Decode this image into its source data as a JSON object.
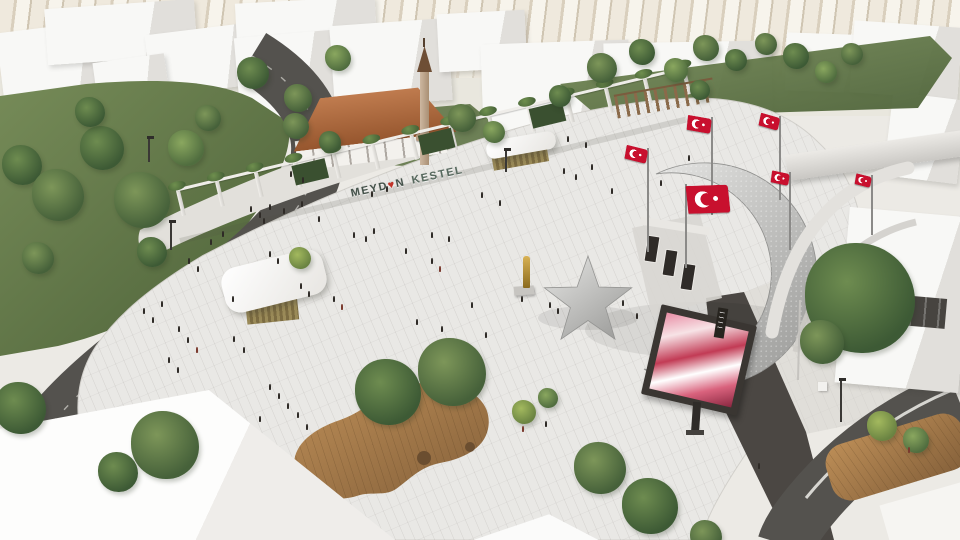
{
  "sign": {
    "word1": "MEYD",
    "heart": "♥",
    "word2": "N",
    "word3": "KESTEL"
  },
  "colors": {
    "flag_red": "#c8102e",
    "flag_red_dark": "#a50f26",
    "asphalt": "#54524e",
    "paving": "#e9e8e5",
    "roof_terracotta": "#b06a3e",
    "gold": "#c9a13b",
    "metal_light": "#e6e6e4",
    "metal_dark": "#9e9e9c",
    "wood_light": "#bd8e57",
    "wood_dark": "#84603a",
    "tree_tones": [
      [
        "#7d9659",
        "#46613a"
      ],
      [
        "#6e8c50",
        "#3d5a35"
      ],
      [
        "#8aa75f",
        "#506d3f"
      ],
      [
        "#a3b95e",
        "#6a8342"
      ]
    ],
    "people": [
      "#2e2a26",
      "#3b342d",
      "#4a3a31",
      "#574a40",
      "#7a3a2e"
    ]
  },
  "scene": {
    "pergola": {
      "x": 182,
      "y": 216,
      "len": 520,
      "angle": -13.5,
      "posts": 14,
      "panels": [
        118,
        248,
        362
      ]
    },
    "trees": [
      [
        22,
        165,
        20,
        1
      ],
      [
        58,
        195,
        26,
        0
      ],
      [
        102,
        148,
        22,
        1
      ],
      [
        142,
        200,
        28,
        0
      ],
      [
        186,
        148,
        18,
        2
      ],
      [
        90,
        112,
        15,
        1
      ],
      [
        208,
        118,
        13,
        0
      ],
      [
        152,
        252,
        15,
        1
      ],
      [
        38,
        258,
        16,
        0
      ],
      [
        20,
        408,
        26,
        1
      ],
      [
        165,
        445,
        34,
        0
      ],
      [
        118,
        472,
        20,
        1
      ],
      [
        253,
        73,
        16,
        1
      ],
      [
        298,
        98,
        14,
        0
      ],
      [
        338,
        58,
        13,
        2
      ],
      [
        296,
        126,
        13,
        0
      ],
      [
        330,
        142,
        11,
        1
      ],
      [
        462,
        118,
        14,
        0
      ],
      [
        494,
        132,
        11,
        2
      ],
      [
        560,
        96,
        11,
        1
      ],
      [
        602,
        68,
        15,
        0
      ],
      [
        642,
        52,
        13,
        1
      ],
      [
        676,
        70,
        12,
        2
      ],
      [
        706,
        48,
        13,
        0
      ],
      [
        736,
        60,
        11,
        1
      ],
      [
        766,
        44,
        11,
        0
      ],
      [
        796,
        56,
        13,
        1
      ],
      [
        826,
        72,
        11,
        2
      ],
      [
        852,
        54,
        11,
        0
      ],
      [
        700,
        90,
        10,
        1
      ],
      [
        388,
        392,
        33,
        1,
        14
      ],
      [
        452,
        372,
        34,
        0,
        16
      ],
      [
        524,
        412,
        12,
        3
      ],
      [
        548,
        398,
        10,
        2
      ],
      [
        600,
        468,
        26,
        0
      ],
      [
        650,
        506,
        28,
        1
      ],
      [
        706,
        536,
        16,
        0
      ],
      [
        860,
        298,
        55,
        1
      ],
      [
        822,
        342,
        22,
        0
      ],
      [
        882,
        426,
        15,
        3
      ],
      [
        916,
        440,
        13,
        2
      ],
      [
        300,
        258,
        11,
        3
      ]
    ],
    "people": [
      [
        143,
        313
      ],
      [
        152,
        322
      ],
      [
        161,
        306
      ],
      [
        178,
        331
      ],
      [
        187,
        342
      ],
      [
        196,
        352,
        4
      ],
      [
        168,
        362
      ],
      [
        177,
        372
      ],
      [
        233,
        341
      ],
      [
        243,
        352
      ],
      [
        188,
        263
      ],
      [
        197,
        271
      ],
      [
        250,
        211
      ],
      [
        259,
        217
      ],
      [
        269,
        209
      ],
      [
        300,
        288
      ],
      [
        308,
        296
      ],
      [
        269,
        256
      ],
      [
        277,
        263
      ],
      [
        318,
        221
      ],
      [
        333,
        301
      ],
      [
        341,
        309,
        4
      ],
      [
        232,
        301
      ],
      [
        353,
        237
      ],
      [
        365,
        241
      ],
      [
        373,
        233
      ],
      [
        405,
        253
      ],
      [
        431,
        263
      ],
      [
        439,
        271,
        4
      ],
      [
        416,
        324
      ],
      [
        441,
        331
      ],
      [
        471,
        307
      ],
      [
        485,
        337
      ],
      [
        521,
        301
      ],
      [
        549,
        307
      ],
      [
        557,
        313
      ],
      [
        431,
        237
      ],
      [
        448,
        241
      ],
      [
        371,
        196
      ],
      [
        386,
        191
      ],
      [
        563,
        173
      ],
      [
        575,
        179
      ],
      [
        591,
        169
      ],
      [
        611,
        193
      ],
      [
        567,
        141
      ],
      [
        585,
        147
      ],
      [
        481,
        197
      ],
      [
        499,
        205
      ],
      [
        301,
        206
      ],
      [
        283,
        213
      ],
      [
        263,
        223
      ],
      [
        522,
        431,
        4
      ],
      [
        545,
        426
      ],
      [
        269,
        389
      ],
      [
        278,
        398
      ],
      [
        287,
        408
      ],
      [
        297,
        417
      ],
      [
        259,
        421
      ],
      [
        306,
        429
      ],
      [
        908,
        452,
        4
      ],
      [
        688,
        160
      ],
      [
        660,
        185
      ],
      [
        636,
        318
      ],
      [
        622,
        305
      ],
      [
        222,
        236
      ],
      [
        210,
        244
      ],
      [
        290,
        176
      ],
      [
        302,
        182
      ],
      [
        758,
        468
      ]
    ],
    "flags": [
      {
        "x": 648,
        "y": 252,
        "h": 104,
        "w": 22,
        "fh": 14,
        "side": "left",
        "rot": 10
      },
      {
        "x": 712,
        "y": 215,
        "h": 98,
        "w": 24,
        "fh": 15,
        "side": "left",
        "rot": 6
      },
      {
        "x": 780,
        "y": 200,
        "h": 84,
        "w": 20,
        "fh": 13,
        "side": "left",
        "rot": 12
      },
      {
        "x": 790,
        "y": 250,
        "h": 78,
        "w": 18,
        "fh": 12,
        "side": "left",
        "rot": 8
      },
      {
        "x": 686,
        "y": 268,
        "h": 84,
        "w": 42,
        "fh": 28,
        "side": "right",
        "rot": -6
      },
      {
        "x": 872,
        "y": 235,
        "h": 60,
        "w": 16,
        "fh": 11,
        "side": "left",
        "rot": 10
      }
    ],
    "lamps": [
      [
        148,
        162,
        24
      ],
      [
        170,
        250,
        28
      ],
      [
        505,
        172,
        22
      ],
      [
        840,
        422,
        42
      ]
    ]
  }
}
